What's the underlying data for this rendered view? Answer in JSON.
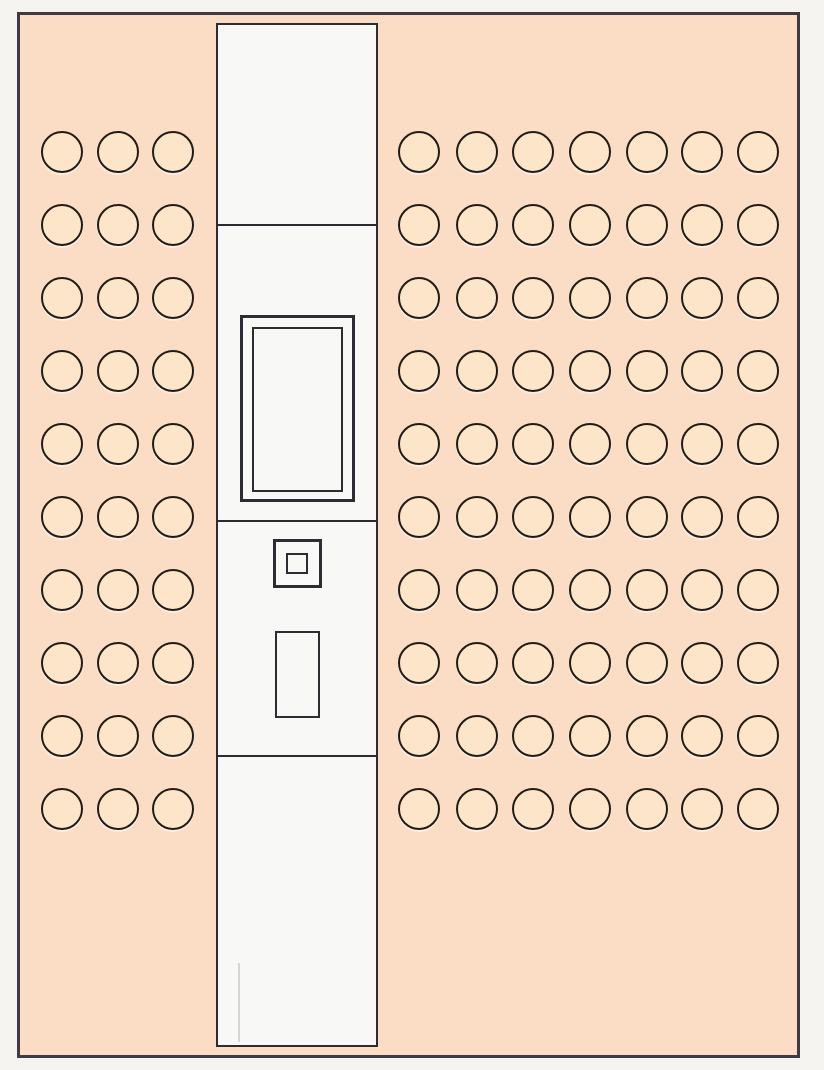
{
  "diagram": {
    "description": "Architectural plan fragment: peach board with two grids of circular markers flanking a white center column that contains framed fixtures",
    "outside_color": "#f5f4f1",
    "board": {
      "x": 17,
      "y": 12,
      "width": 783,
      "height": 1046,
      "fill": "#fbdcc5",
      "stroke": "#413a44",
      "stroke_width": 3
    },
    "hole_style": {
      "diameter": 42,
      "fill": "#fde5c9",
      "stroke": "#221b15",
      "stroke_width": 2,
      "highlight": "rgba(255,255,255,0.55)"
    },
    "hole_grids": [
      {
        "id": "left-hole-grid",
        "col_centers": [
          62,
          118,
          173
        ],
        "rows": 10,
        "row_start": 152,
        "row_spacing": 73
      },
      {
        "id": "right-hole-grid",
        "col_centers": [
          419,
          477,
          533,
          590,
          647,
          702,
          758
        ],
        "rows": 10,
        "row_start": 152,
        "row_spacing": 73
      }
    ],
    "center_column": {
      "x": 216,
      "y": 23,
      "width": 162,
      "height": 1024,
      "fill": "#f8f8f6",
      "stroke": "#2e2b33",
      "stroke_width": 2,
      "dividers_y": [
        224,
        520,
        755
      ],
      "divider_thickness": 2
    },
    "fixture_stroke": "#2e2b33",
    "fixtures": [
      {
        "id": "framed-panel-outer",
        "x": 240,
        "y": 315,
        "width": 115,
        "height": 187,
        "stroke_width": 3
      },
      {
        "id": "framed-panel-inner",
        "x": 252,
        "y": 327,
        "width": 91,
        "height": 165,
        "stroke_width": 2
      },
      {
        "id": "small-square-outer",
        "x": 273,
        "y": 539,
        "width": 49,
        "height": 49,
        "stroke_width": 3
      },
      {
        "id": "small-square-inner",
        "x": 286,
        "y": 553,
        "width": 22,
        "height": 21,
        "stroke_width": 2
      },
      {
        "id": "tall-small-rect",
        "x": 275,
        "y": 631,
        "width": 45,
        "height": 87,
        "stroke_width": 2
      }
    ],
    "faint_line": {
      "x": 238,
      "y_start": 963,
      "y_end": 1042,
      "width": 2,
      "color": "#d9d6d0"
    }
  }
}
